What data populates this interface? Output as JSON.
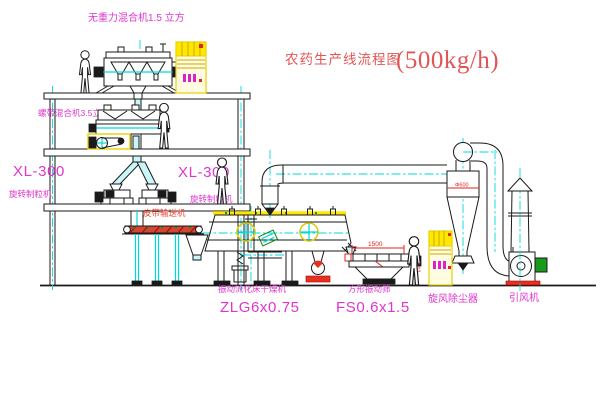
{
  "title": {
    "text": "农药生产线流程图",
    "capacity": "(500kg/h)"
  },
  "equipment_labels": {
    "gravity_mixer": "无重力混合机1.5 立方",
    "ribbon_mixer": "螺带混合机3.5立方",
    "granulator_left": {
      "model": "XL-300",
      "name": "旋转制粒机"
    },
    "granulator_mid": {
      "model": "XL-300",
      "name": "旋转制粒机"
    },
    "belt_conveyor": "皮带输送机",
    "fluid_bed_dryer": {
      "name": "振动流化床干燥机",
      "model": "ZLG6x0.75"
    },
    "vibrating_sieve": {
      "name": "方形振动筛",
      "model": "FS0.6x1.5"
    },
    "cyclone": "旋风除尘器",
    "induced_draft_fan": "引风机"
  },
  "dimensions": {
    "sieve_length": "1500",
    "sieve_height": "941",
    "cyclone_diameter": "Φ600"
  },
  "colors": {
    "label_magenta": "#df35cf",
    "title_red": "#e25555",
    "dimension_red": "#e42222",
    "centerline_cyan": "#00d9d9",
    "highlight_yellow": "#e9cf00",
    "motor_green": "#0d8a0d"
  }
}
